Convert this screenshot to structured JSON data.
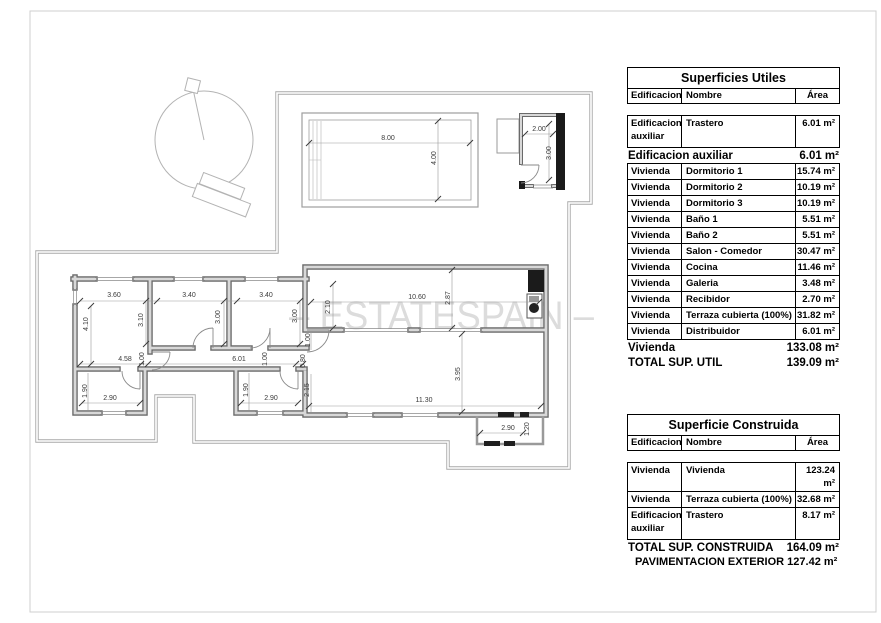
{
  "watermark": {
    "text": "– ESTATESPAIN –"
  },
  "plan": {
    "dims": {
      "pool_w": "8.00",
      "pool_h": "4.00",
      "shed_w": "2.00",
      "shed_h": "3.00",
      "bed1_w": "3.60",
      "bed1_h_left": "4.10",
      "bed1_h_right": "3.10",
      "bed2_w": "3.40",
      "bed2_h": "3.00",
      "bed3_w": "3.40",
      "bed3_h": "3.00",
      "hall_seg1": "4.58",
      "hall_w1": "1.00",
      "hall_seg2": "6.01",
      "hall_w2": "1.00",
      "entry_door": "1.00",
      "entry_pass": "0.80",
      "entry_wall": "2.15",
      "bath1_h": "1.90",
      "bath1_w": "2.90",
      "bath2_h": "1.90",
      "bath2_w": "2.90",
      "terrace_left": "2.10",
      "terrace_w": "10.60",
      "terrace_h": "2.87",
      "living_w": "11.30",
      "living_h": "3.95",
      "porch_w": "2.90",
      "porch_h": "1.20"
    }
  },
  "tables": {
    "utiles": {
      "title": "Superficies Utiles",
      "col_edificacion": "Edificacion",
      "col_nombre": "Nombre",
      "col_area": "Área",
      "first_row": {
        "edificacion": "Edificacion auxiliar",
        "nombre": "Trastero",
        "area": "6.01 m²"
      },
      "subtotal1": {
        "label": "Edificacion auxiliar",
        "area": "6.01 m²"
      },
      "rows": [
        {
          "edificacion": "Vivienda",
          "nombre": "Dormitorio 1",
          "area": "15.74 m²"
        },
        {
          "edificacion": "Vivienda",
          "nombre": "Dormitorio 2",
          "area": "10.19 m²"
        },
        {
          "edificacion": "Vivienda",
          "nombre": "Dormitorio 3",
          "area": "10.19 m²"
        },
        {
          "edificacion": "Vivienda",
          "nombre": "Baño 1",
          "area": "5.51 m²"
        },
        {
          "edificacion": "Vivienda",
          "nombre": "Baño 2",
          "area": "5.51 m²"
        },
        {
          "edificacion": "Vivienda",
          "nombre": "Salon - Comedor",
          "area": "30.47 m²"
        },
        {
          "edificacion": "Vivienda",
          "nombre": "Cocina",
          "area": "11.46 m²"
        },
        {
          "edificacion": "Vivienda",
          "nombre": "Galeria",
          "area": "3.48 m²"
        },
        {
          "edificacion": "Vivienda",
          "nombre": "Recibidor",
          "area": "2.70 m²"
        },
        {
          "edificacion": "Vivienda",
          "nombre": "Terraza cubierta (100%)",
          "area": "31.82 m²"
        },
        {
          "edificacion": "Vivienda",
          "nombre": "Distribuidor",
          "area": "6.01 m²"
        }
      ],
      "subtotal2": {
        "label": "Vivienda",
        "area": "133.08 m²"
      },
      "total": {
        "label": "TOTAL SUP. UTIL",
        "area": "139.09 m²"
      }
    },
    "construida": {
      "title": "Superficie Construida",
      "col_edificacion": "Edificacion",
      "col_nombre": "Nombre",
      "col_area": "Área",
      "rows": [
        {
          "edificacion": "Vivienda",
          "nombre": "Vivienda",
          "area": "123.24 m²"
        },
        {
          "edificacion": "Vivienda",
          "nombre": "Terraza cubierta (100%)",
          "area": "32.68 m²"
        },
        {
          "edificacion": "Edificacion auxiliar",
          "nombre": "Trastero",
          "area": "8.17 m²"
        }
      ],
      "total": {
        "label": "TOTAL SUP. CONSTRUIDA",
        "area": "164.09 m²"
      }
    }
  },
  "footer": {
    "pavimentacion": "PAVIMENTACION EXTERIOR 127.42 m²"
  }
}
